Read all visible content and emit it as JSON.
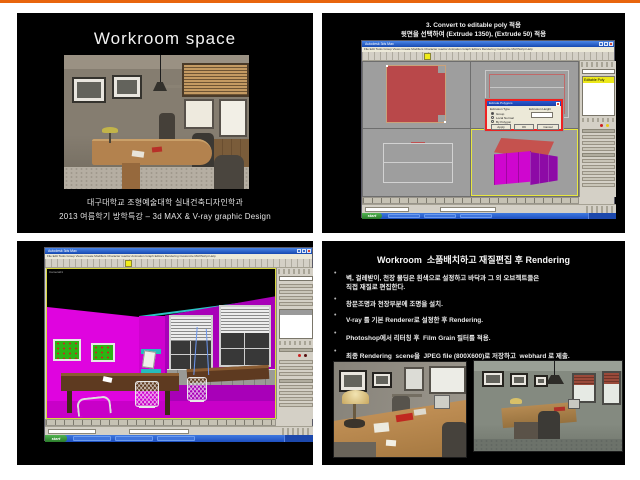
{
  "colors": {
    "accent_orange": "#e8650d",
    "slide_bg": "#000000",
    "magenta_wall": "#df04df",
    "purple_face": "#8d0aa6",
    "magenta_face": "#cf06cf",
    "red_face": "#c5524e",
    "red_shape": "#b9484a",
    "viewport_grey": "#9e9e9e",
    "active_viewport_border": "#e8e840",
    "taskbar_blue": "#2a5cd0",
    "start_green": "#3aa03a",
    "highlight_yellow": "#ece81a",
    "teal_shelf": "#26bcbc"
  },
  "slide1": {
    "title": "Workroom space",
    "caption1": "대구대학교 조형예술대학 실내건축디자인학과",
    "caption2": "2013 여름학기 방학특강 – 3d MAX & V-ray graphic Design"
  },
  "slide2": {
    "heading1": "3. Convert to editable poly 적용",
    "heading2": "윗면을 선택하여 (Extrude 1350), (Extrude 50) 적용",
    "dialog": {
      "title": "Extrude Polygons",
      "group": "Extrusion Type",
      "r1": "Group",
      "r2": "Local Normal",
      "r3": "By Polygon",
      "height": "Extrusion Height",
      "apply": "Apply",
      "ok": "OK",
      "cancel": "Cancel"
    }
  },
  "max": {
    "window_title": "Autodesk 3ds Max",
    "menu_text": "File Edit Tools Group Views Create Modifiers Character reactor Animation Graph Editors Rendering Customize MAXScript Help",
    "modifier_selected": "Editable Poly",
    "camera_label": "Camera01",
    "start_label": "start"
  },
  "slide4": {
    "title": "Workroom  소품배치하고 재질편집 후 Rendering",
    "bullet_char": "•",
    "bullets": [
      {
        "text": "벽, 걸레받이, 천장 몰딩은 흰색으로 설정하고 바닥과 그 외 오브젝트들은",
        "text2": "직접 재질로 편집한다."
      },
      {
        "text": "창문조명과 천장부분에 조명을 설치.",
        "text2": ""
      },
      {
        "text": "V-ray 를 기본 Renderer로 설정한 후 Rendering.",
        "text2": ""
      },
      {
        "text": "Photoshop에서 리터칭 후  Film Grain 필터를 적용.",
        "text2": ""
      },
      {
        "text": "최종 Rendering  scene을  JPEG file (800X600)로 저장하고  webhard 로 제출.",
        "text2": ""
      }
    ]
  }
}
